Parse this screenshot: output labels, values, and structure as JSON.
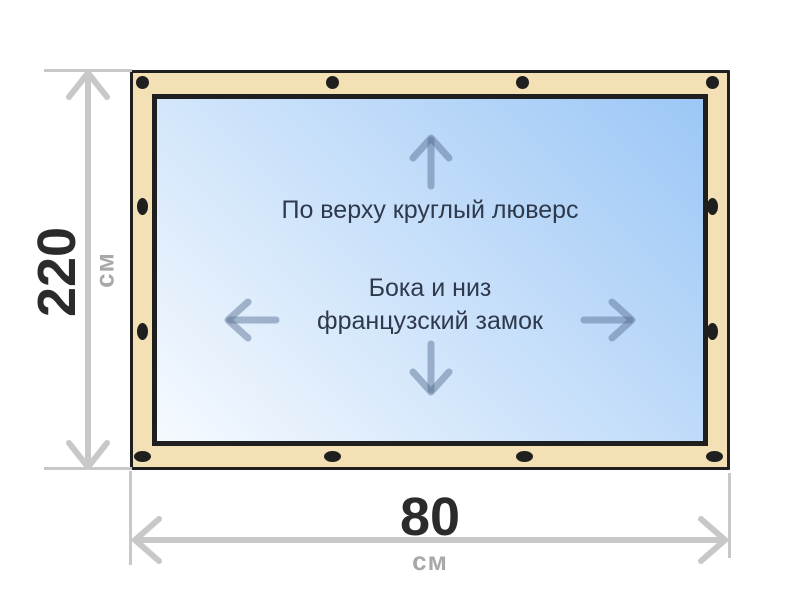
{
  "diagram": {
    "type": "curtain-dimension-diagram",
    "annotations": {
      "top_edge": "По верху круглый люверс",
      "sides_line1": "Бока и низ",
      "sides_line2": "французский замок"
    },
    "dimensions": {
      "height": {
        "value": "220",
        "unit": "см"
      },
      "width": {
        "value": "80",
        "unit": "см"
      }
    },
    "fasteners": {
      "top_count": 4,
      "bottom_count": 4,
      "left_count": 2,
      "right_count": 2
    },
    "icons": {
      "up": "arrow-up-icon",
      "down": "arrow-down-icon",
      "left": "arrow-left-icon",
      "right": "arrow-right-icon",
      "height_dim": "double-arrow-vertical-icon",
      "width_dim": "double-arrow-horizontal-icon"
    }
  },
  "colors": {
    "frame_fill": "#f3e0b5",
    "outline": "#1f1f1f",
    "window_start": "#f6fafe",
    "window_end": "#9cc7f6",
    "inner_arrow": "rgba(80,105,140,0.45)",
    "dim_line": "#c8c8c8",
    "dim_value": "#2b2b2b",
    "dim_unit": "#a8a8a8",
    "annotation": "#2e3a4c"
  }
}
